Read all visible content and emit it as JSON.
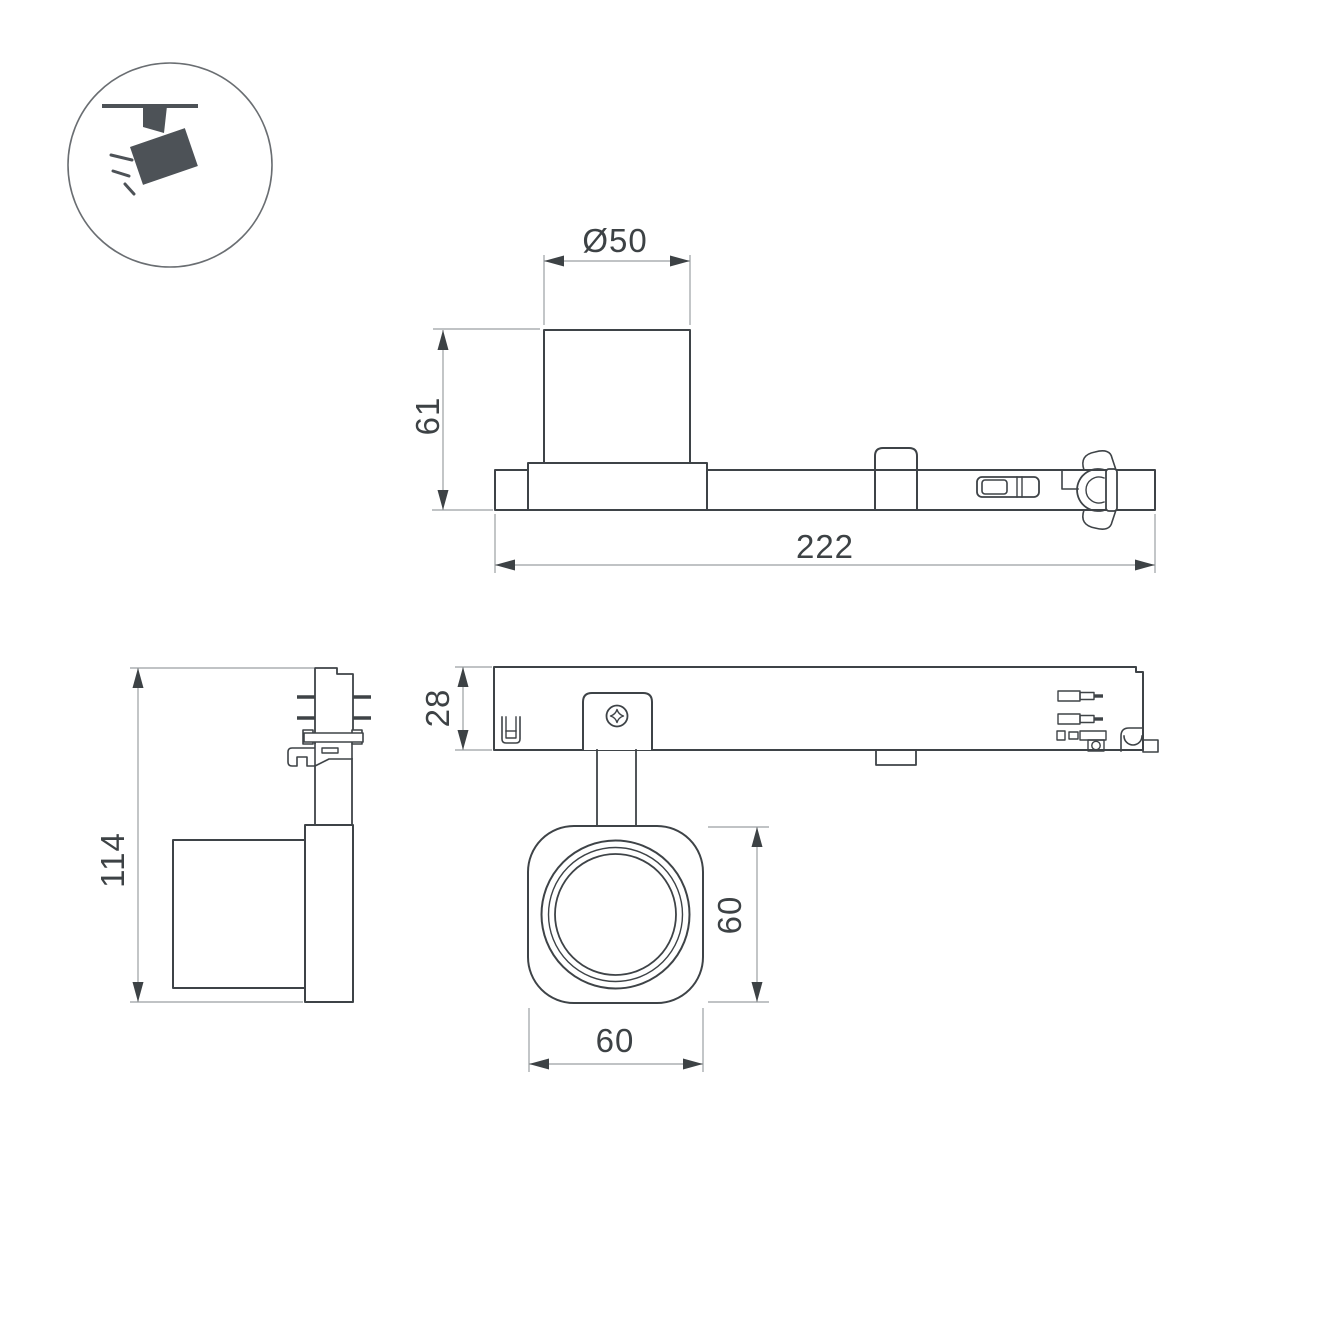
{
  "document": {
    "type": "dimensioned technical drawing — track-mounted LED spotlight",
    "background": "#ffffff"
  },
  "palette": {
    "object_line": "#3e4347",
    "dim_line": "#9b9fa2",
    "text": "#3d4245",
    "icon_fill": "#4d5257",
    "icon_ring": "#6a6e72"
  },
  "legend_icon": {
    "meaning": "ceiling-track-spotlight-pictogram"
  },
  "views": {
    "side_view": {
      "dim_diameter": "Ø50",
      "dim_height": "61",
      "dim_length": "222"
    },
    "end_view": {
      "dim_total_height": "114"
    },
    "plan_view": {
      "dim_body_depth": "28",
      "dim_head_height": "60",
      "dim_head_width": "60"
    }
  }
}
